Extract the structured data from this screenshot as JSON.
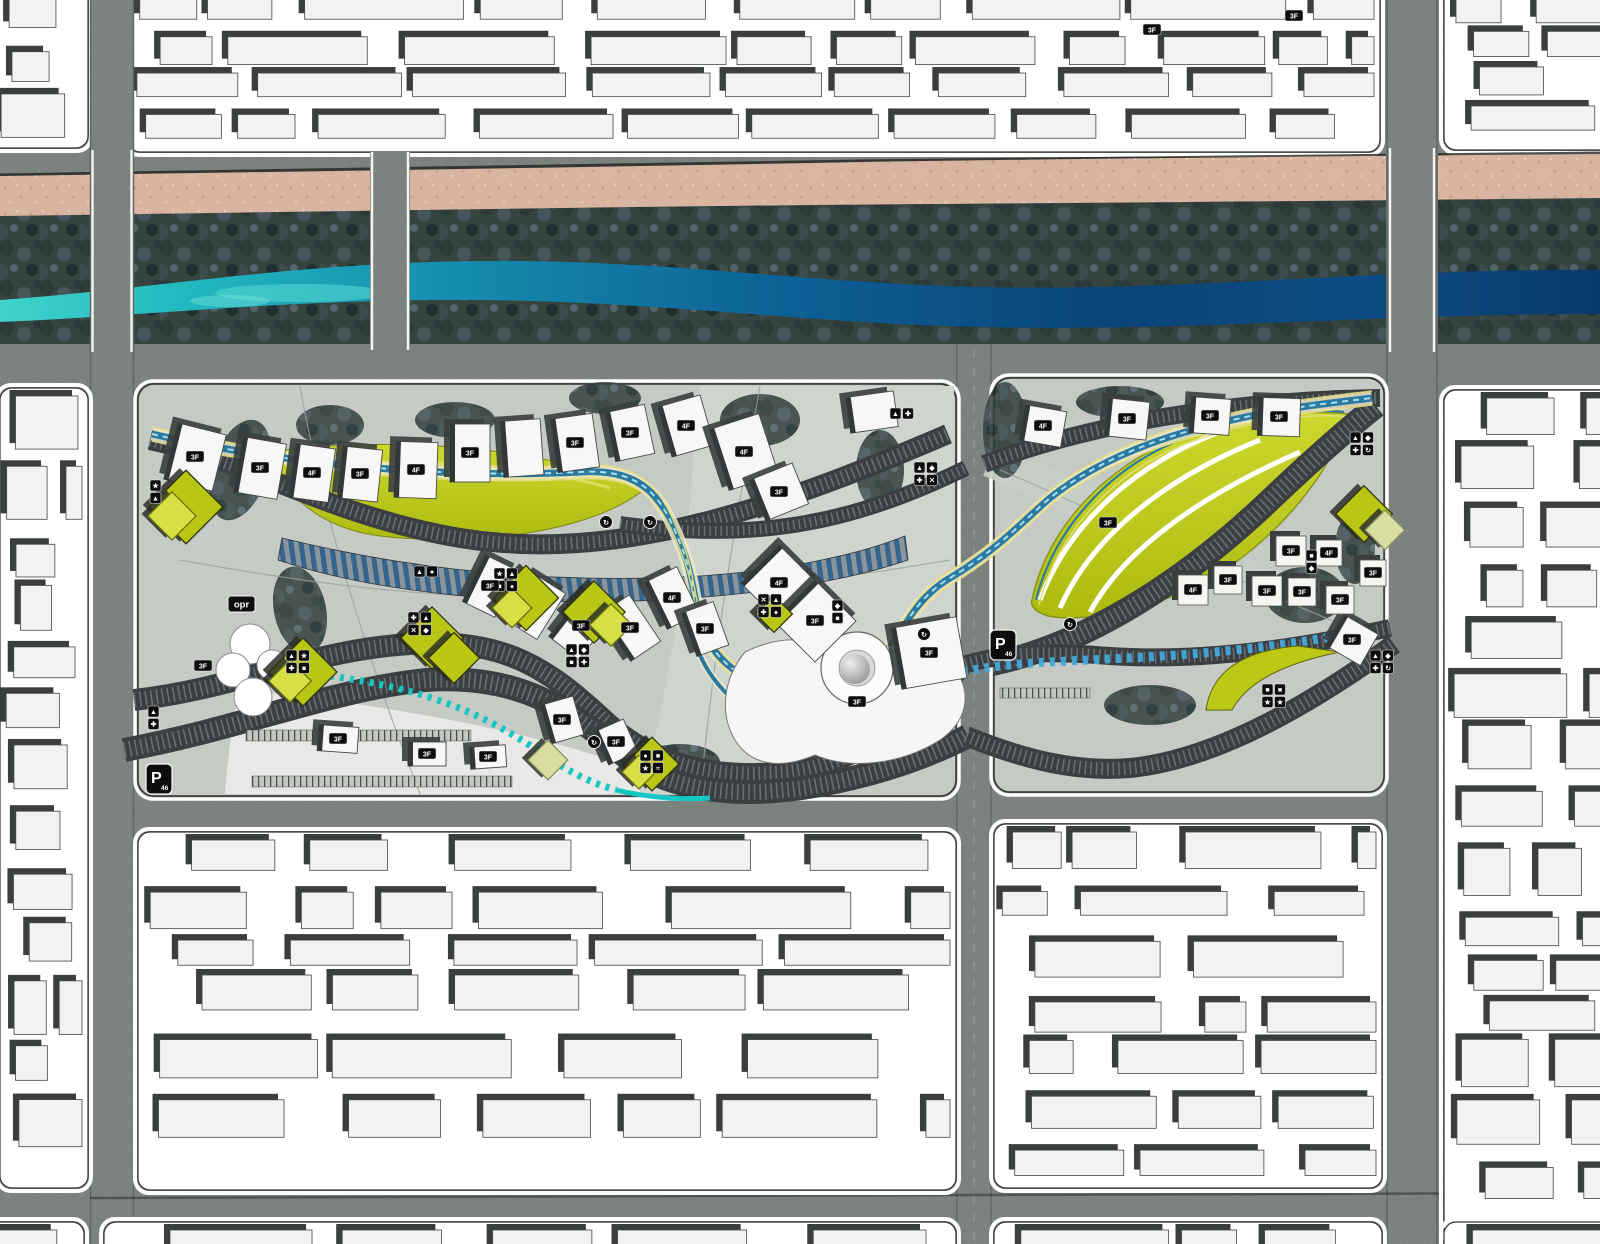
{
  "page": {
    "title": "Riverfront corridor urban design masterplan"
  },
  "colors": {
    "road": "#7c827e",
    "block_white": "#ffffff",
    "building_fill": "#f2f2f0",
    "building_shadow": "#3a3f3d",
    "sand": "#d9b5a1",
    "vegetation": "#36443f",
    "river_teal": "#3ed3ca",
    "river_deep": "#0a3a6b",
    "panel_gray": "#c6cac5",
    "ribbon_dark": "#3b3f42",
    "park_yellow": "#bcc816",
    "park_yellow_light": "#d6e045",
    "canal_blue": "#2a7aa1",
    "canal_dash_blue": "#42a8da",
    "canal_teal_dash": "#14c6c4",
    "badge_black": "#0d0d0d",
    "label_text": "#ffffff"
  },
  "labels": {
    "opr": "opr",
    "parking": "P",
    "parking_sub": "46"
  },
  "map": {
    "slabs": [
      {
        "x": 170,
        "y": 428,
        "w": 50,
        "h": 58,
        "r": 14,
        "label": "3F"
      },
      {
        "x": 238,
        "y": 440,
        "w": 44,
        "h": 56,
        "r": 10,
        "label": "3F"
      },
      {
        "x": 292,
        "y": 446,
        "w": 40,
        "h": 54,
        "r": 8,
        "label": "4F"
      },
      {
        "x": 340,
        "y": 448,
        "w": 40,
        "h": 52,
        "r": 6,
        "label": "3F"
      },
      {
        "x": 395,
        "y": 442,
        "w": 42,
        "h": 56,
        "r": 2,
        "label": "4F"
      },
      {
        "x": 450,
        "y": 424,
        "w": 40,
        "h": 58,
        "r": 0,
        "label": "3F"
      },
      {
        "x": 502,
        "y": 420,
        "w": 40,
        "h": 56,
        "r": -4
      },
      {
        "x": 554,
        "y": 416,
        "w": 42,
        "h": 54,
        "r": -8,
        "label": "3F"
      },
      {
        "x": 610,
        "y": 408,
        "w": 40,
        "h": 50,
        "r": -12,
        "label": "3F"
      },
      {
        "x": 664,
        "y": 400,
        "w": 44,
        "h": 52,
        "r": -16,
        "label": "4F"
      },
      {
        "x": 718,
        "y": 420,
        "w": 52,
        "h": 64,
        "r": -18,
        "label": "4F"
      },
      {
        "x": 756,
        "y": 470,
        "w": 46,
        "h": 44,
        "r": -22,
        "label": "3F"
      },
      {
        "x": 848,
        "y": 394,
        "w": 48,
        "h": 36,
        "r": -8
      },
      {
        "x": 472,
        "y": 560,
        "w": 36,
        "h": 52,
        "r": 26,
        "label": "3F"
      },
      {
        "x": 518,
        "y": 580,
        "w": 36,
        "h": 54,
        "r": 32
      },
      {
        "x": 562,
        "y": 598,
        "w": 38,
        "h": 56,
        "r": 38,
        "label": "3F"
      },
      {
        "x": 612,
        "y": 600,
        "w": 36,
        "h": 56,
        "r": -34,
        "label": "3F"
      },
      {
        "x": 654,
        "y": 572,
        "w": 36,
        "h": 52,
        "r": -26,
        "label": "4F"
      },
      {
        "x": 688,
        "y": 606,
        "w": 34,
        "h": 46,
        "r": -20,
        "label": "3F"
      },
      {
        "x": 752,
        "y": 556,
        "w": 54,
        "h": 54,
        "r": 45,
        "label": "4F"
      },
      {
        "x": 786,
        "y": 592,
        "w": 58,
        "h": 58,
        "r": 45,
        "label": "3F"
      },
      {
        "x": 896,
        "y": 622,
        "w": 66,
        "h": 62,
        "r": -10,
        "label": "3F"
      },
      {
        "x": 318,
        "y": 726,
        "w": 40,
        "h": 26,
        "r": 4,
        "label": "3F"
      },
      {
        "x": 408,
        "y": 742,
        "w": 38,
        "h": 24,
        "r": 0,
        "label": "3F"
      },
      {
        "x": 470,
        "y": 746,
        "w": 36,
        "h": 22,
        "r": -4,
        "label": "3F"
      },
      {
        "x": 545,
        "y": 700,
        "w": 34,
        "h": 40,
        "r": -16,
        "label": "3F"
      },
      {
        "x": 600,
        "y": 724,
        "w": 32,
        "h": 36,
        "r": -24,
        "label": "3F"
      },
      {
        "x": 1022,
        "y": 408,
        "w": 42,
        "h": 36,
        "r": 10,
        "label": "4F"
      },
      {
        "x": 1106,
        "y": 400,
        "w": 42,
        "h": 38,
        "r": 6,
        "label": "3F"
      },
      {
        "x": 1190,
        "y": 398,
        "w": 40,
        "h": 36,
        "r": 4,
        "label": "3F"
      },
      {
        "x": 1258,
        "y": 398,
        "w": 42,
        "h": 38,
        "r": 2,
        "label": "3F"
      },
      {
        "x": 1332,
        "y": 622,
        "w": 40,
        "h": 36,
        "r": 30,
        "label": "3F"
      }
    ],
    "courtyards": [
      {
        "x": 1178,
        "y": 575,
        "s": 30,
        "label": "4F"
      },
      {
        "x": 1214,
        "y": 566,
        "s": 28,
        "label": "3F"
      },
      {
        "x": 1252,
        "y": 576,
        "s": 30,
        "label": "3F"
      },
      {
        "x": 1288,
        "y": 578,
        "s": 28,
        "label": "3F"
      },
      {
        "x": 1276,
        "y": 536,
        "s": 30,
        "label": "3F"
      },
      {
        "x": 1316,
        "y": 540,
        "s": 26,
        "label": "4F"
      },
      {
        "x": 1326,
        "y": 586,
        "s": 28,
        "label": "3F"
      },
      {
        "x": 1360,
        "y": 560,
        "s": 26,
        "label": "3F"
      }
    ],
    "diamonds": [
      {
        "x": 186,
        "y": 507,
        "s": 52,
        "v": "g"
      },
      {
        "x": 172,
        "y": 516,
        "s": 34,
        "v": "b"
      },
      {
        "x": 303,
        "y": 672,
        "s": 48,
        "v": "g"
      },
      {
        "x": 290,
        "y": 681,
        "s": 30,
        "v": "b"
      },
      {
        "x": 432,
        "y": 638,
        "s": 44,
        "v": "g"
      },
      {
        "x": 454,
        "y": 658,
        "s": 36,
        "v": "g"
      },
      {
        "x": 526,
        "y": 598,
        "s": 46,
        "v": "g"
      },
      {
        "x": 512,
        "y": 608,
        "s": 28,
        "v": "b"
      },
      {
        "x": 594,
        "y": 612,
        "s": 44,
        "v": "g"
      },
      {
        "x": 611,
        "y": 625,
        "s": 30,
        "v": "b"
      },
      {
        "x": 652,
        "y": 764,
        "s": 38,
        "v": "g"
      },
      {
        "x": 639,
        "y": 772,
        "s": 24,
        "v": "b"
      },
      {
        "x": 548,
        "y": 760,
        "s": 28,
        "v": "p"
      },
      {
        "x": 774,
        "y": 614,
        "s": 26,
        "v": "g"
      },
      {
        "x": 1364,
        "y": 514,
        "s": 40,
        "v": "g"
      },
      {
        "x": 1385,
        "y": 530,
        "s": 28,
        "v": "p"
      }
    ],
    "badge_clusters": [
      {
        "x": 890,
        "y": 408,
        "cols": 2,
        "rows": 1,
        "icons": [
          "trail",
          "bike"
        ]
      },
      {
        "x": 914,
        "y": 462,
        "cols": 2,
        "rows": 2,
        "icons": [
          "trail",
          "view",
          "bike",
          "cross"
        ]
      },
      {
        "x": 1350,
        "y": 432,
        "cols": 2,
        "rows": 2,
        "icons": [
          "trail",
          "view",
          "bike",
          "loop"
        ]
      },
      {
        "x": 606,
        "y": 522,
        "circle": true,
        "icons": [
          "loop"
        ]
      },
      {
        "x": 650,
        "y": 522,
        "circle": true,
        "icons": [
          "loop"
        ]
      },
      {
        "x": 414,
        "y": 566,
        "cols": 2,
        "rows": 1,
        "icons": [
          "trail",
          "park"
        ]
      },
      {
        "x": 408,
        "y": 612,
        "cols": 2,
        "rows": 2,
        "icons": [
          "bike",
          "trail",
          "cross",
          "view"
        ]
      },
      {
        "x": 494,
        "y": 568,
        "cols": 2,
        "rows": 2,
        "icons": [
          "sport",
          "trail",
          "rest",
          "park"
        ]
      },
      {
        "x": 566,
        "y": 644,
        "cols": 2,
        "rows": 2,
        "icons": [
          "trail",
          "view",
          "rest",
          "bike"
        ]
      },
      {
        "x": 758,
        "y": 594,
        "cols": 2,
        "rows": 2,
        "icons": [
          "cross",
          "trail",
          "bike",
          "park"
        ]
      },
      {
        "x": 832,
        "y": 600,
        "cols": 1,
        "rows": 2,
        "icons": [
          "view",
          "rest"
        ]
      },
      {
        "x": 286,
        "y": 650,
        "cols": 2,
        "rows": 2,
        "icons": [
          "trail",
          "sport",
          "bike",
          "rest"
        ]
      },
      {
        "x": 640,
        "y": 750,
        "cols": 2,
        "rows": 2,
        "icons": [
          "park",
          "rest",
          "sport",
          "water"
        ]
      },
      {
        "x": 1306,
        "y": 550,
        "cols": 1,
        "rows": 2,
        "icons": [
          "rest",
          "view"
        ]
      },
      {
        "x": 1262,
        "y": 684,
        "cols": 2,
        "rows": 2,
        "icons": [
          "rest",
          "rest",
          "sport",
          "sport"
        ]
      },
      {
        "x": 1370,
        "y": 650,
        "cols": 2,
        "rows": 2,
        "icons": [
          "trail",
          "view",
          "bike",
          "loop"
        ]
      },
      {
        "x": 924,
        "y": 634,
        "circle": true,
        "icons": [
          "loop"
        ]
      },
      {
        "x": 1070,
        "y": 624,
        "circle": true,
        "icons": [
          "loop"
        ]
      },
      {
        "x": 148,
        "y": 706,
        "cols": 1,
        "rows": 2,
        "icons": [
          "trail",
          "bike"
        ]
      },
      {
        "x": 150,
        "y": 480,
        "cols": 1,
        "rows": 2,
        "icons": [
          "sport",
          "trail"
        ]
      },
      {
        "x": 594,
        "y": 742,
        "circle": true,
        "icons": [
          "loop"
        ]
      }
    ],
    "floor_labels": [
      {
        "t": "3F",
        "x": 203,
        "y": 666
      },
      {
        "t": "3F",
        "x": 857,
        "y": 702
      },
      {
        "t": "3F",
        "x": 1108,
        "y": 523
      },
      {
        "t": "3F",
        "x": 1152,
        "y": 30
      },
      {
        "t": "3F",
        "x": 1294,
        "y": 16
      }
    ],
    "parking_badges": [
      {
        "x": 146,
        "y": 764
      },
      {
        "x": 990,
        "y": 630
      }
    ],
    "opr_badge": {
      "x": 228,
      "y": 596
    }
  }
}
